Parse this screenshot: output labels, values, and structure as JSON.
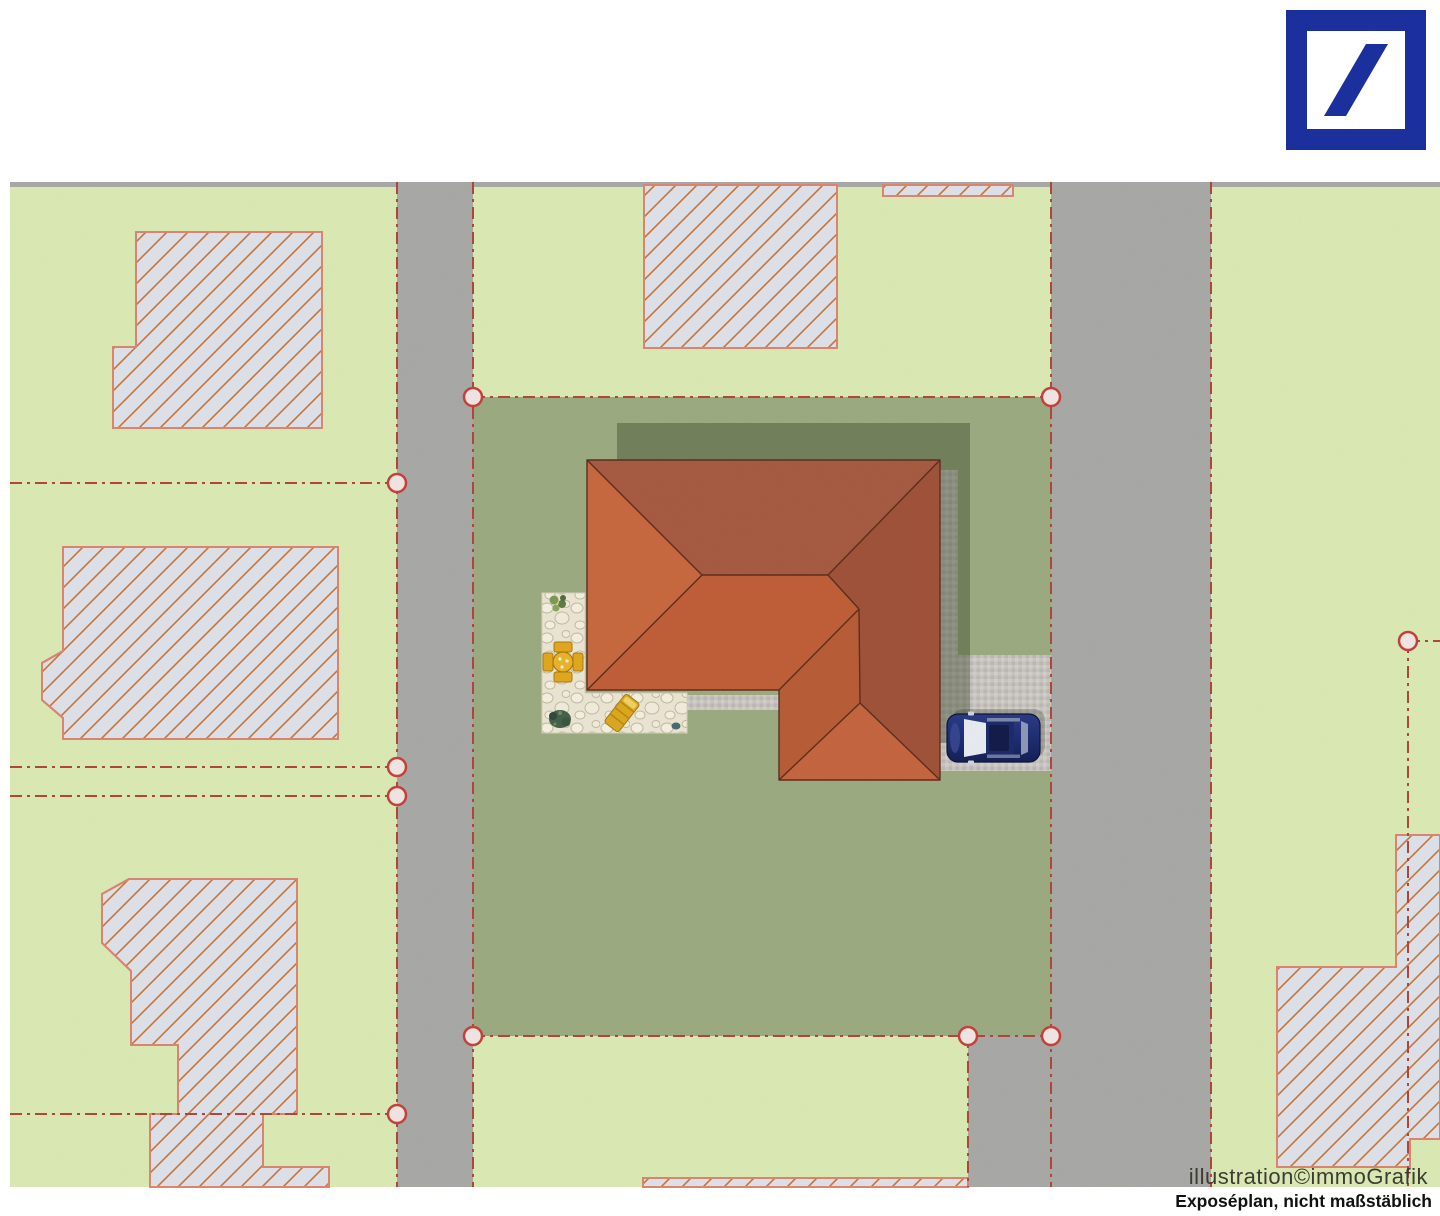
{
  "captions": {
    "credit": "illustration©immoGrafik",
    "disclaimer": "Exposéplan, nicht maßstäblich"
  },
  "branding": {
    "logo_icon": "deutsche-bank-logo",
    "logo_color": "#1b2f9d"
  },
  "colors": {
    "background": "#ffffff",
    "canvas_top_strip": "#a9a9a7",
    "parcel_light_green": "#dcebb5",
    "subject_lawn_green": "#9cab82",
    "road_gray": "#a9a9a7",
    "boundary_red": "#b0453c",
    "marker_fill": "#efe3e1",
    "marker_stroke": "#c4403a",
    "building_fill": "#dfe3ea",
    "building_border": "#dd8572",
    "building_hatch": "#c5763d",
    "roof_north": "#a75a42",
    "roof_east": "#a0523a",
    "roof_west": "#c8683f",
    "roof_south": "#c05e38",
    "roof_ext_west": "#b85c36",
    "roof_ext_south": "#c56540",
    "roof_ridge": "#5d2d1d",
    "shadow": "#3a4428",
    "patio_stone": "#ece7d5",
    "pavement": "#c9c5c1",
    "car_body": "#1e2c74",
    "furniture_yellow": "#e2a81e"
  },
  "scene": {
    "type": "site-plan-illustration",
    "subject_parcel": {
      "boundary_style": "red dash-dot with circular corner markers",
      "marker_count": 10,
      "contains": [
        "hip-roof-house",
        "stone-patio",
        "driveway",
        "parked-car",
        "lawn"
      ]
    },
    "roads": {
      "count": 2,
      "orientation": "vertical"
    },
    "neighbor_buildings": {
      "count": 7,
      "style": "diagonal-hatched outlines"
    },
    "car": {
      "color_name": "dark blue",
      "location": "driveway",
      "facing": "left"
    },
    "patio_furniture": [
      "table-with-four-chairs",
      "sun-lounger",
      "plants"
    ]
  }
}
